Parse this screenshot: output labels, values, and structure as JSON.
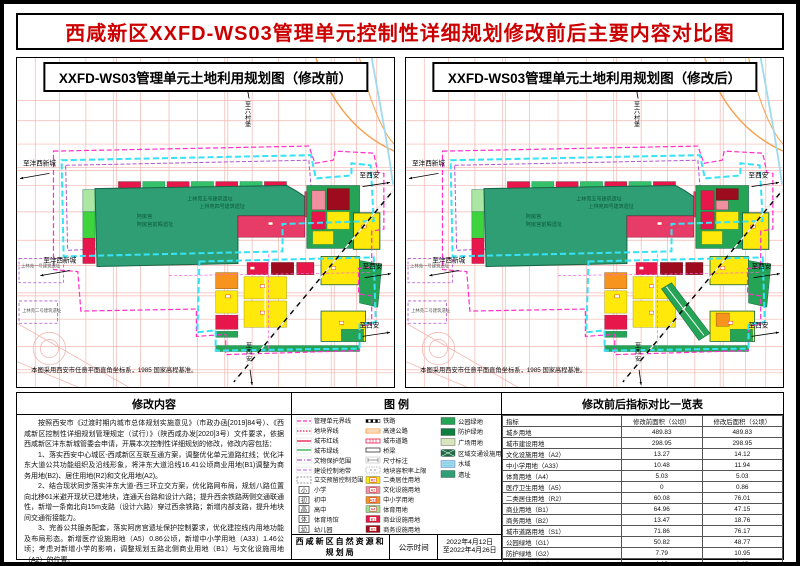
{
  "page_title": "西咸新区XXFD-WS03管理单元控制性详细规划修改前后主要内容对比图",
  "colors": {
    "title_red": "#cc0000",
    "boundary_magenta": "#ff2fc8",
    "greenline_cyan": "#38e2f5",
    "protection_purple": "#b057ce",
    "ruins_green": "#2f9e74",
    "park_green": "#25a455",
    "shield_green": "#0e7e3e",
    "plaza_green": "#d9e6bd",
    "land_yellow": "#ffe90a",
    "commercial_red": "#e8174b",
    "business_darkred": "#9c0b1e",
    "culture_pink": "#f08fa0",
    "school_orange": "#f7941d",
    "sport_green": "#9fdf8f",
    "water_blue": "#9fdbee",
    "highway_orange": "#f5a14b"
  },
  "maps": {
    "left": {
      "title": "XXFD-WS03管理单元土地利用规划图（修改前）"
    },
    "right": {
      "title": "XXFD-WS03管理单元土地利用规划图（修改后）"
    },
    "labels": {
      "north": "至六村堡",
      "west": "至沣西新城",
      "east": "至西安",
      "south": "至西安",
      "site1": "阿房宫",
      "site2": "阿房宫前殿遗址",
      "site3": "上林苑五号建筑遗址",
      "site4": "上林苑四号建筑遗址",
      "site5": "上林苑一号建筑遗址",
      "site6": "上林苑二号建筑遗址",
      "note": "本图采用西安市任意平面直角坐标系，1985 国家高程基准。"
    }
  },
  "modification": {
    "header": "修改内容",
    "paragraphs": [
      "按照西安市《过渡时期内城市总体规划实施意见》（市政办函[2019]84号）、《西咸新区控制性详细规划管理规定（试行）》（陕西咸办发[2020]3号）文件要求，依据西咸新区沣东新城管委会申请，开展本次控制性详细规划的修改，修改内容包括：",
      "1、落实西安中心城区-西咸新区互联互通方案，调整优化单元道路红线；优化沣东大道公共功能组织及沿线形象，将沣东大道沿线16.41公顷商业用地(B1)调整为商务用地(B2)、居住用地(R2)和文化用地(A2)。",
      "2、结合现状同步落实沣东大道-西三环立交方案，优化路网布局，规划八路位置向北移61米避开现状已建地块，连通天台路和设计六路；提升西余铁路两侧交通联通性，新增一条南北向15m支路（设计六路）穿过西余铁路；新增内部支路，提升地块间交通衔接能力。",
      "3、完善公共服务配套，落实阿房宫遗址保护控制要求，优化建控线内用地功能及布局形态。新增医疗设施用地（A5）0.86公顷，新增中小学用地（A33）1.46公顷；考虑对新增小学的影响，调整规划五路北侧商业用地（B1）与文化设施用地（A2）的位置。"
    ]
  },
  "legend": {
    "header": "图 例",
    "columns": [
      [
        {
          "label": "管理单元界线",
          "swatch": {
            "type": "line",
            "color": "#ff2fc8",
            "dash": "4 2"
          }
        },
        {
          "label": "地块界线",
          "swatch": {
            "type": "line",
            "color": "#e8174b",
            "dash": "1.5 1.5"
          }
        },
        {
          "label": "城市红线",
          "swatch": {
            "type": "line",
            "color": "#e8174b",
            "dash": ""
          }
        },
        {
          "label": "城市绿线",
          "swatch": {
            "type": "line",
            "color": "#22b14c",
            "dash": ""
          }
        },
        {
          "label": "文物保护范围",
          "swatch": {
            "type": "line",
            "color": "#b057ce",
            "dash": "5 2 1 2"
          }
        },
        {
          "label": "建设控制地带",
          "swatch": {
            "type": "line",
            "color": "#cf7fe0",
            "dash": "4 2"
          }
        },
        {
          "label": "立交预留控制范围",
          "swatch": {
            "type": "dashbox",
            "color": "#777777"
          }
        },
        {
          "label": "小学",
          "swatch": {
            "type": "school",
            "char": "小"
          }
        },
        {
          "label": "初中",
          "swatch": {
            "type": "school",
            "char": "初"
          }
        },
        {
          "label": "高中",
          "swatch": {
            "type": "school",
            "char": "高"
          }
        },
        {
          "label": "体育场馆",
          "swatch": {
            "type": "school",
            "char": "体"
          }
        },
        {
          "label": "幼儿园",
          "swatch": {
            "type": "school",
            "char": "幼"
          }
        }
      ],
      [
        {
          "label": "铁路",
          "swatch": {
            "type": "railway",
            "color": "#000000"
          }
        },
        {
          "label": "高速公路",
          "swatch": {
            "type": "dline",
            "color": "#f5a14b"
          }
        },
        {
          "label": "城市道路",
          "swatch": {
            "type": "crossroad",
            "color": "#e8174b"
          }
        },
        {
          "label": "桥梁",
          "swatch": {
            "type": "bridge",
            "color": "#000000"
          }
        },
        {
          "label": "尺寸标注",
          "swatch": {
            "type": "dim",
            "color": "#555555"
          }
        },
        {
          "label": "地块容积率上限",
          "swatch": {
            "type": "far",
            "color": "#888888"
          }
        },
        {
          "label": "二类居住用地",
          "swatch": {
            "type": "land",
            "color": "#ffe90a",
            "code": "R2"
          }
        },
        {
          "label": "文化设施用地",
          "swatch": {
            "type": "land",
            "color": "#f08fa0",
            "code": "A2"
          }
        },
        {
          "label": "中小学用地",
          "swatch": {
            "type": "land",
            "color": "#f7941d",
            "code": "A33"
          }
        },
        {
          "label": "体育用地",
          "swatch": {
            "type": "land",
            "color": "#9fdf8f",
            "code": "A4"
          }
        },
        {
          "label": "商业设施用地",
          "swatch": {
            "type": "land",
            "color": "#e8174b",
            "code": "B1"
          }
        },
        {
          "label": "商务设施用地",
          "swatch": {
            "type": "land",
            "color": "#9c0b1e",
            "code": "B2"
          }
        }
      ],
      [
        {
          "label": "公园绿地",
          "swatch": {
            "type": "fill",
            "color": "#25a455"
          }
        },
        {
          "label": "防护绿地",
          "swatch": {
            "type": "fill",
            "color": "#0e7e3e"
          }
        },
        {
          "label": "广场用地",
          "swatch": {
            "type": "fill",
            "color": "#d9e6bd"
          }
        },
        {
          "label": "区域交通设施用地",
          "swatch": {
            "type": "xhatch",
            "color": "#1d6b45"
          }
        },
        {
          "label": "水域",
          "swatch": {
            "type": "water",
            "color": "#9fdbee"
          }
        },
        {
          "label": "遗址",
          "swatch": {
            "type": "fill",
            "color": "#2f9e74"
          }
        }
      ]
    ]
  },
  "table": {
    "header": "修改前后指标对比一览表",
    "columns": [
      "指标",
      "修改前面积（公顷）",
      "修改后面积（公顷）"
    ],
    "rows": [
      [
        "城乡用地",
        "489.83",
        "489.83"
      ],
      [
        "城市建设用地",
        "298.95",
        "298.95"
      ],
      [
        "文化设施用地（A2）",
        "13.27",
        "14.12"
      ],
      [
        "中小学用地（A33）",
        "10.48",
        "11.94"
      ],
      [
        "体育用地（A4）",
        "5.03",
        "5.03"
      ],
      [
        "医疗卫生用地（A5）",
        "0",
        "0.86"
      ],
      [
        "二类居住用地（R2）",
        "60.08",
        "76.01"
      ],
      [
        "商业用地（B1）",
        "64.96",
        "47.15"
      ],
      [
        "商务用地（B2）",
        "13.47",
        "18.76"
      ],
      [
        "城市道路用地（S1）",
        "71.86",
        "76.17"
      ],
      [
        "公园绿地（G1）",
        "50.82",
        "48.77"
      ],
      [
        "防护绿地（G2）",
        "7.79",
        "10.95"
      ],
      [
        "广场用地（G3）",
        "1.19",
        "1.19"
      ],
      [
        "农林用地（E2）",
        "177.82",
        "177.82"
      ],
      [
        "地上总建筑面积（万平方米）",
        "338.56",
        "337.23"
      ]
    ]
  },
  "footer": {
    "agency": "西咸新区自然资源和规划局",
    "label": "公示时间",
    "date_line1": "2022年4月12日",
    "date_line2": "至2022年4月26日"
  }
}
